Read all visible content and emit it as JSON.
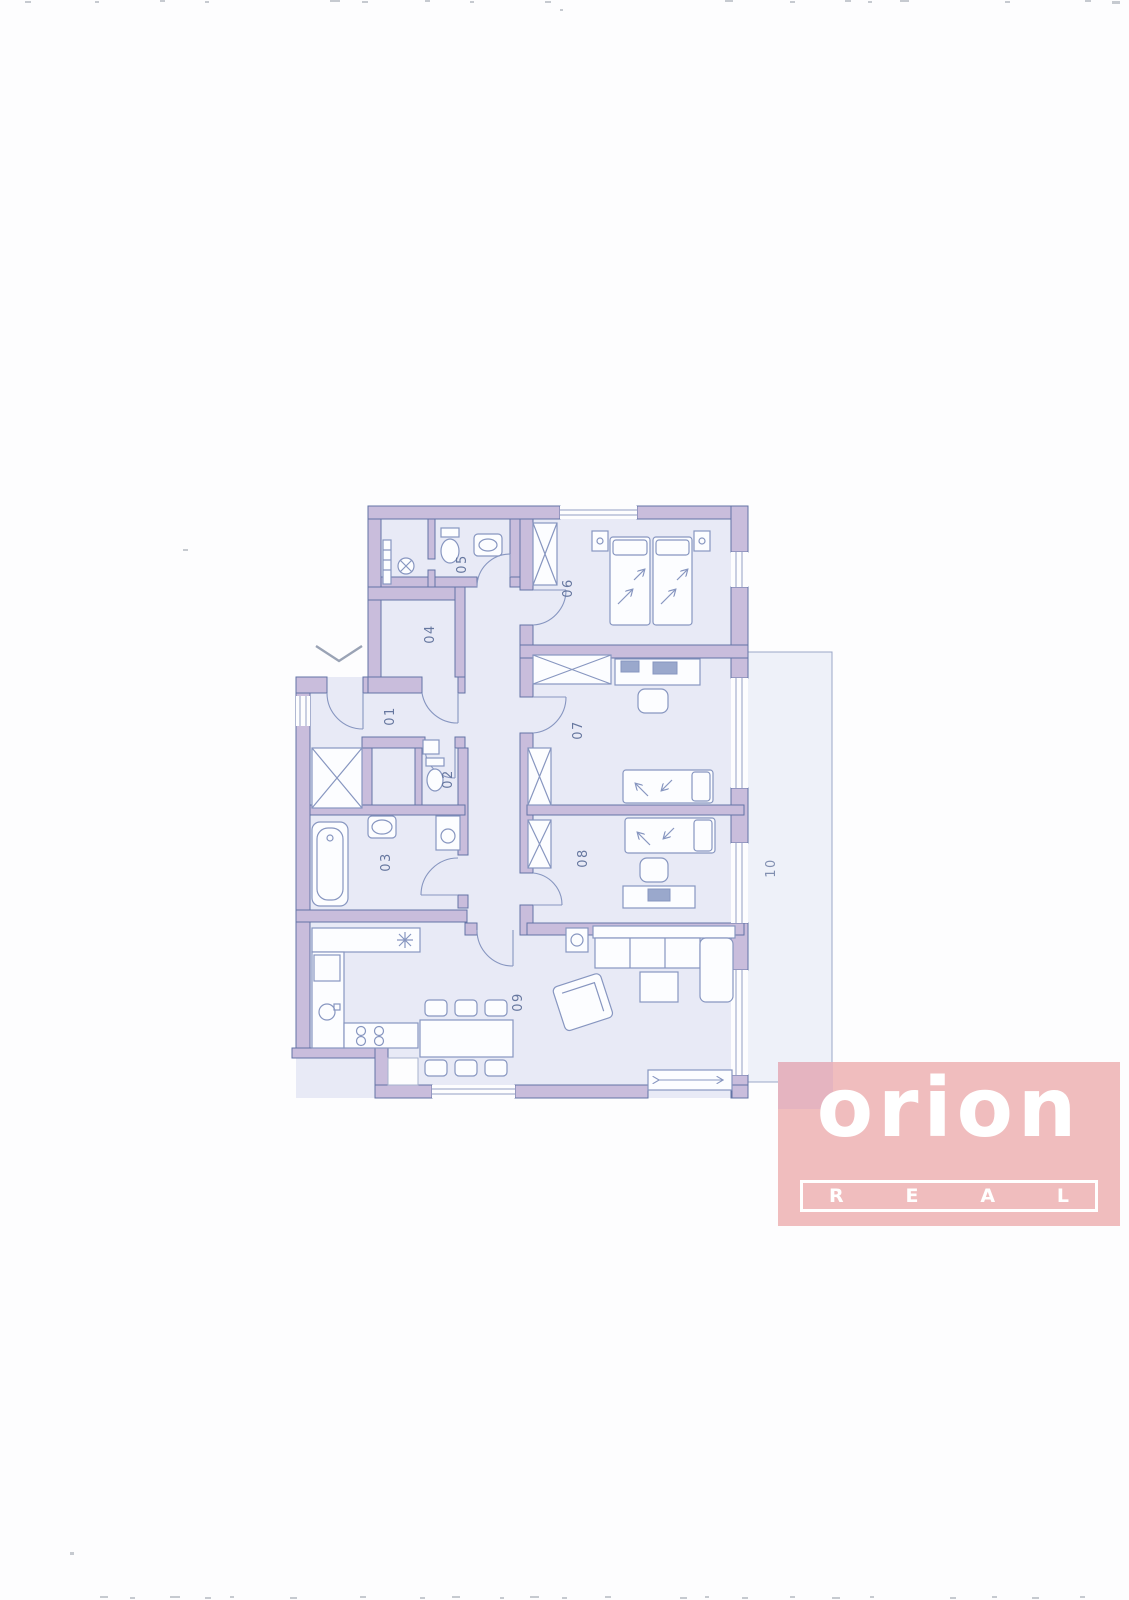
{
  "plan": {
    "room_labels": [
      "01",
      "02",
      "03",
      "04",
      "05",
      "06",
      "07",
      "08",
      "09",
      "10"
    ]
  },
  "logo": {
    "brand": "orion",
    "letters": [
      "R",
      "E",
      "A",
      "L"
    ]
  },
  "colors": {
    "wall": "#c9bddc",
    "wallStroke": "#6374a6",
    "roomFill": "#e8eaf6",
    "furn": "#8796c0",
    "label": "#66779f",
    "terraceFill": "#eef1f9",
    "logoBg": "#f0bdbe",
    "logoText": "#ffffff",
    "logoOverlap": "#e5b4c0"
  }
}
